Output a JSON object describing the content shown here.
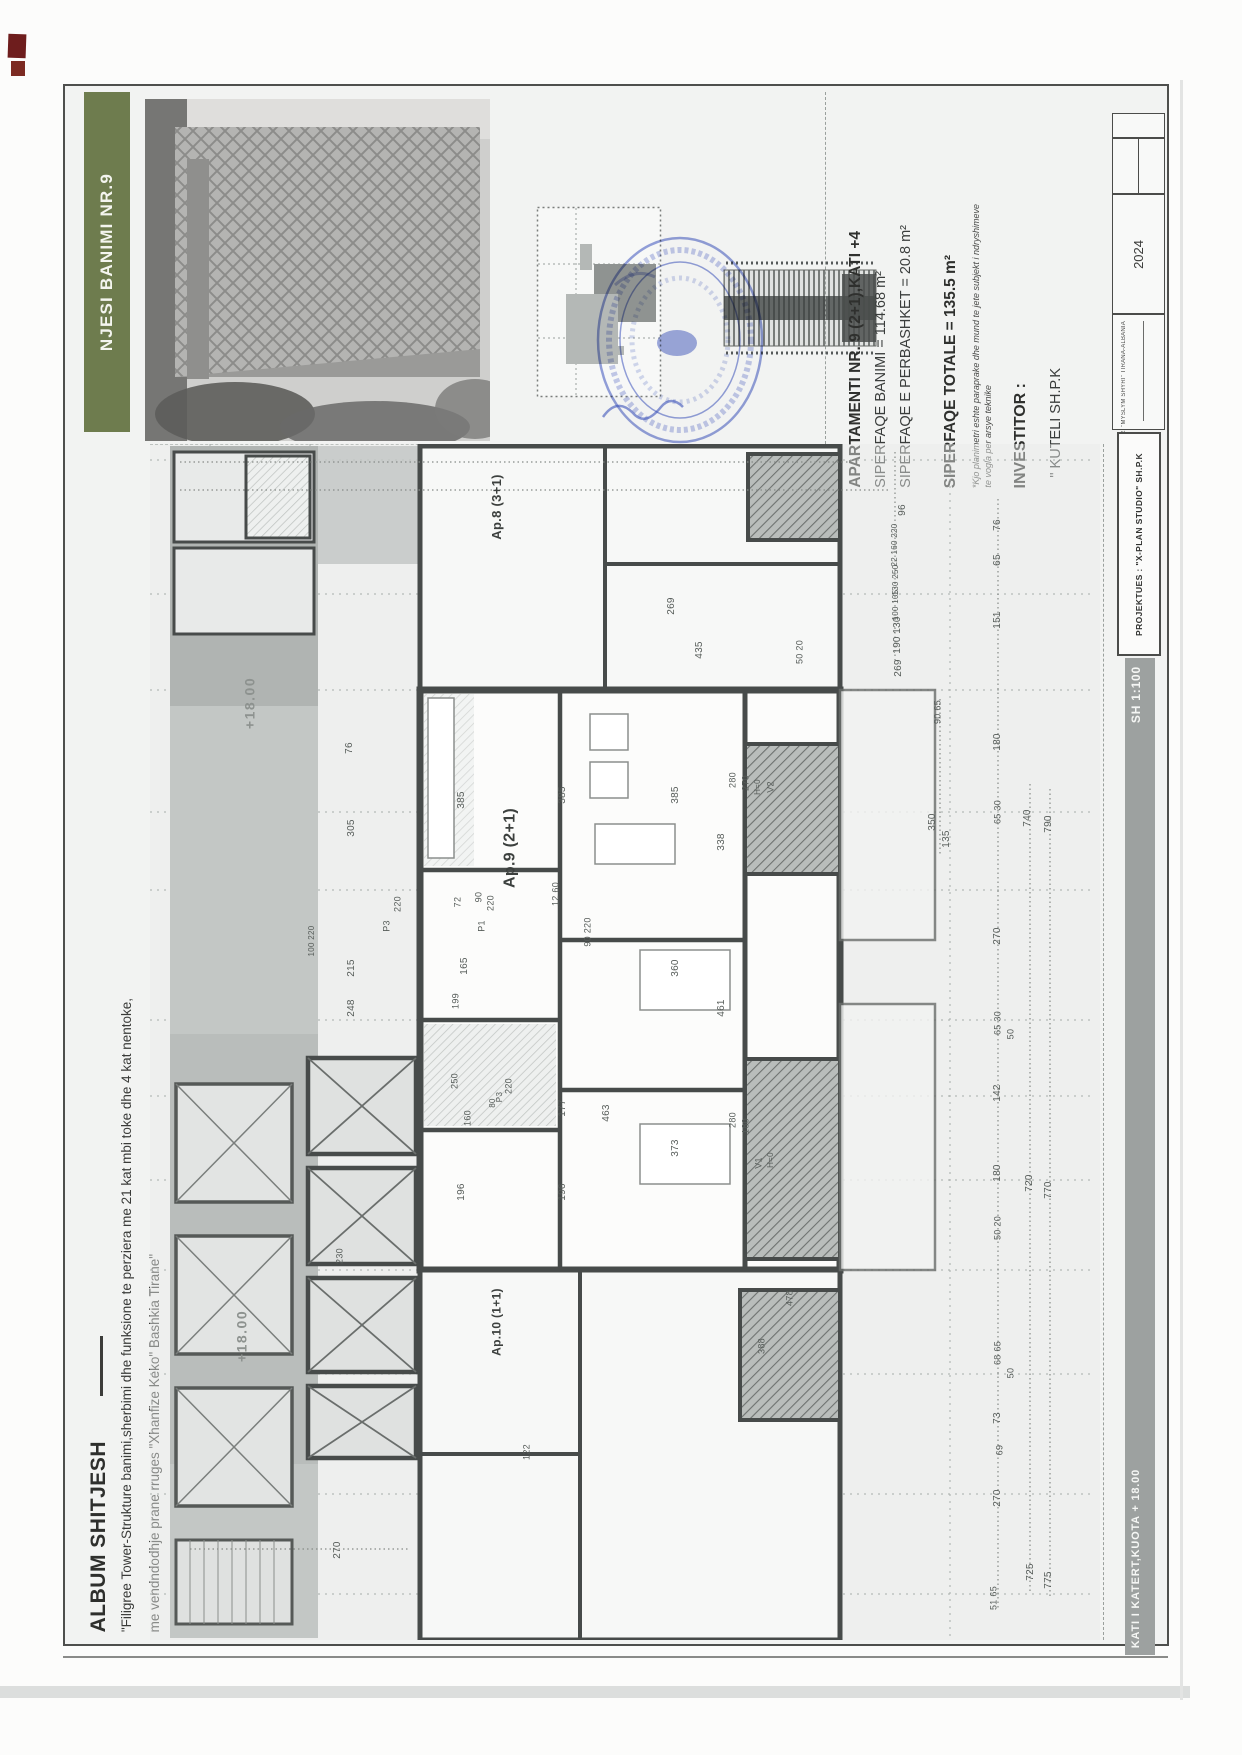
{
  "sheet": {
    "header_band": "NJESI BANIMI NR.9",
    "album_title": "ALBUM SHITJESH",
    "album_desc_line1": "\"Filigree Tower-Strukture banimi,sherbimi dhe funksione te perziera me 21 kat mbi toke dhe 4 kat nentoke,",
    "album_desc_line2": "me vendndodhje prane rruges \"Xhanfize Keko\" Bashkia Tirane\"",
    "floor_bar_label": "KATI I KATERT,KUOTA + 18.00",
    "scale_label": "SH 1:100",
    "projektues": "PROJEKTUES :  \"X-PLAN STUDIO\" SH.P.K",
    "year": "2024",
    "studio_address": "RR. \"MYSLYM SHYRI\" TIRANA-ALBANIA"
  },
  "apartment_info": {
    "title": "APARTAMENTI NR. 9 (2+1),KATI +4",
    "area_living": "SIPERFAQE BANIMI = 114.68 m²",
    "area_shared": "SIPERFAQE E PERBASHKET = 20.8 m²",
    "area_total": "SIPERFAQE TOTALE = 135.5 m²",
    "note1": "*Kjo planimetri eshte paraprake dhe mund te jete subjekt i ndryshimeve",
    "note2": "te vogla per arsye teknike",
    "investor_label": "INVESTITOR :",
    "investor_name": "\" KUTELI SH.P.K"
  },
  "plan": {
    "labels": [
      {
        "t": "Ap.8 (3+1)",
        "x": 497,
        "y": 507,
        "fs": 13,
        "cls": "apt"
      },
      {
        "t": "Ap.9 (2+1)",
        "x": 511,
        "y": 848,
        "fs": 16,
        "cls": "apt"
      },
      {
        "t": "Ap.10 (1+1)",
        "x": 497,
        "y": 1322,
        "fs": 12,
        "cls": "apt"
      },
      {
        "t": "+18.00",
        "x": 250,
        "y": 703,
        "fs": 14,
        "cls": "lvl"
      },
      {
        "t": "+18.00",
        "x": 242,
        "y": 1336,
        "fs": 14,
        "cls": "lvl"
      },
      {
        "t": "96",
        "x": 903,
        "y": 510
      },
      {
        "t": "22 160 220",
        "x": 895,
        "y": 545,
        "fs": 8
      },
      {
        "t": "130 250",
        "x": 896,
        "y": 580,
        "fs": 8
      },
      {
        "t": "100 105",
        "x": 896,
        "y": 605,
        "fs": 8
      },
      {
        "t": "130",
        "x": 898,
        "y": 625
      },
      {
        "t": "190",
        "x": 898,
        "y": 645
      },
      {
        "t": "269",
        "x": 899,
        "y": 668
      },
      {
        "t": "435",
        "x": 700,
        "y": 650
      },
      {
        "t": "269",
        "x": 672,
        "y": 606
      },
      {
        "t": "50 20",
        "x": 800,
        "y": 652,
        "fs": 9
      },
      {
        "t": "76",
        "x": 350,
        "y": 748
      },
      {
        "t": "305",
        "x": 352,
        "y": 828
      },
      {
        "t": "385",
        "x": 462,
        "y": 800
      },
      {
        "t": "385",
        "x": 563,
        "y": 795
      },
      {
        "t": "385",
        "x": 676,
        "y": 795
      },
      {
        "t": "280",
        "x": 733,
        "y": 780,
        "fs": 9
      },
      {
        "t": "270",
        "x": 746,
        "y": 783,
        "fs": 9
      },
      {
        "t": "H=0",
        "x": 758,
        "y": 787,
        "fs": 8
      },
      {
        "t": "V2",
        "x": 771,
        "y": 787,
        "fs": 9
      },
      {
        "t": "338",
        "x": 722,
        "y": 842
      },
      {
        "t": "350",
        "x": 933,
        "y": 822
      },
      {
        "t": "135",
        "x": 947,
        "y": 839
      },
      {
        "t": "90 65",
        "x": 938,
        "y": 712,
        "fs": 9
      },
      {
        "t": "72",
        "x": 458,
        "y": 902,
        "fs": 9
      },
      {
        "t": "90",
        "x": 479,
        "y": 897,
        "fs": 9
      },
      {
        "t": "220",
        "x": 491,
        "y": 903,
        "fs": 9
      },
      {
        "t": "P1",
        "x": 482,
        "y": 926,
        "fs": 9
      },
      {
        "t": "12 60",
        "x": 556,
        "y": 894,
        "fs": 9
      },
      {
        "t": "90 220",
        "x": 588,
        "y": 932,
        "fs": 9
      },
      {
        "t": "P3",
        "x": 387,
        "y": 926,
        "fs": 9
      },
      {
        "t": "220",
        "x": 398,
        "y": 904,
        "fs": 9
      },
      {
        "t": "100 220",
        "x": 312,
        "y": 941,
        "fs": 8
      },
      {
        "t": "215",
        "x": 352,
        "y": 968
      },
      {
        "t": "165",
        "x": 465,
        "y": 966
      },
      {
        "t": "248",
        "x": 352,
        "y": 1008
      },
      {
        "t": "199",
        "x": 456,
        "y": 1001,
        "fs": 9
      },
      {
        "t": "360",
        "x": 676,
        "y": 968
      },
      {
        "t": "461",
        "x": 722,
        "y": 1008
      },
      {
        "t": "250",
        "x": 455,
        "y": 1081,
        "fs": 9
      },
      {
        "t": "220",
        "x": 509,
        "y": 1086,
        "fs": 9
      },
      {
        "t": "80",
        "x": 493,
        "y": 1103,
        "fs": 8
      },
      {
        "t": "P3",
        "x": 500,
        "y": 1097,
        "fs": 8
      },
      {
        "t": "160",
        "x": 468,
        "y": 1118,
        "fs": 9
      },
      {
        "t": "177",
        "x": 563,
        "y": 1108
      },
      {
        "t": "463",
        "x": 607,
        "y": 1113
      },
      {
        "t": "373",
        "x": 676,
        "y": 1148
      },
      {
        "t": "196",
        "x": 462,
        "y": 1192
      },
      {
        "t": "196",
        "x": 563,
        "y": 1192
      },
      {
        "t": "280",
        "x": 733,
        "y": 1120,
        "fs": 9
      },
      {
        "t": "180",
        "x": 746,
        "y": 1126,
        "fs": 9
      },
      {
        "t": "V1",
        "x": 759,
        "y": 1163,
        "fs": 9
      },
      {
        "t": "H=0",
        "x": 771,
        "y": 1160,
        "fs": 8
      },
      {
        "t": "478",
        "x": 790,
        "y": 1298,
        "fs": 9
      },
      {
        "t": "388",
        "x": 762,
        "y": 1346,
        "fs": 9
      },
      {
        "t": "122",
        "x": 527,
        "y": 1452,
        "fs": 9
      },
      {
        "t": "230",
        "x": 340,
        "y": 1256,
        "fs": 9
      },
      {
        "t": "270",
        "x": 338,
        "y": 1550
      },
      {
        "t": "76",
        "x": 998,
        "y": 525
      },
      {
        "t": "65",
        "x": 998,
        "y": 560
      },
      {
        "t": "151",
        "x": 998,
        "y": 620
      },
      {
        "t": "180",
        "x": 998,
        "y": 742
      },
      {
        "t": "65 30",
        "x": 998,
        "y": 812,
        "fs": 9
      },
      {
        "t": "740",
        "x": 1028,
        "y": 818
      },
      {
        "t": "790",
        "x": 1049,
        "y": 824
      },
      {
        "t": "270",
        "x": 998,
        "y": 936
      },
      {
        "t": "65 30",
        "x": 998,
        "y": 1023,
        "fs": 9
      },
      {
        "t": "50",
        "x": 1011,
        "y": 1034,
        "fs": 9
      },
      {
        "t": "142",
        "x": 998,
        "y": 1093
      },
      {
        "t": "180",
        "x": 998,
        "y": 1173
      },
      {
        "t": "50 20",
        "x": 998,
        "y": 1228,
        "fs": 9
      },
      {
        "t": "720",
        "x": 1030,
        "y": 1183
      },
      {
        "t": "770",
        "x": 1049,
        "y": 1190
      },
      {
        "t": "68 65",
        "x": 998,
        "y": 1353,
        "fs": 9
      },
      {
        "t": "50",
        "x": 1011,
        "y": 1373,
        "fs": 9
      },
      {
        "t": "73",
        "x": 998,
        "y": 1418
      },
      {
        "t": "69",
        "x": 1000,
        "y": 1450,
        "fs": 9
      },
      {
        "t": "270",
        "x": 998,
        "y": 1498
      },
      {
        "t": "725",
        "x": 1031,
        "y": 1572
      },
      {
        "t": "775",
        "x": 1049,
        "y": 1580
      },
      {
        "t": "51 65",
        "x": 994,
        "y": 1598,
        "fs": 9
      }
    ]
  },
  "colors": {
    "header_green": "#6e7c4e",
    "bar_gray": "#9da1a0",
    "stamp_blue": "#3f57c4",
    "wall": "#474b4a"
  }
}
